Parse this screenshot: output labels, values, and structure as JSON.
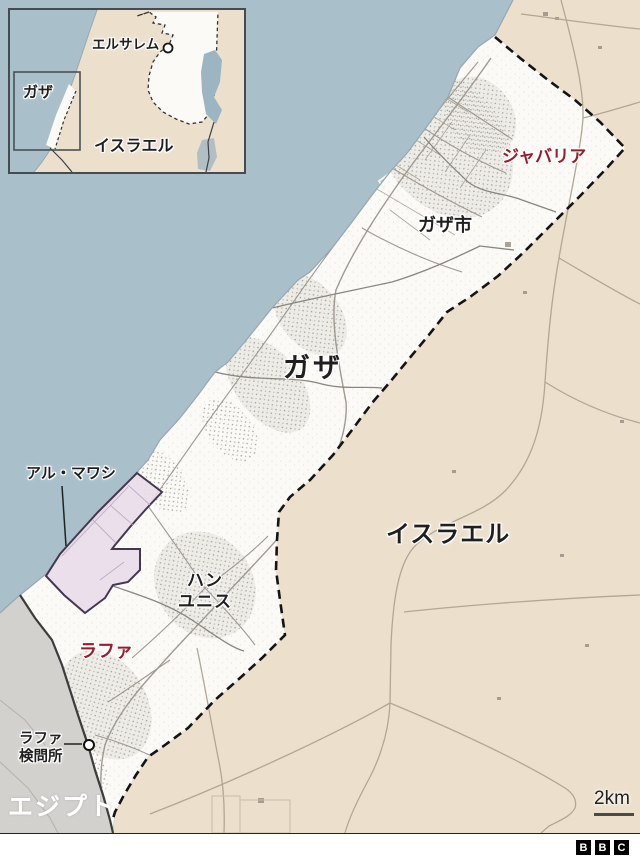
{
  "colors": {
    "sea": "#a9bfca",
    "israel": "#ece0cd",
    "gaza": "#fbfaf7",
    "egypt": "#d3d1ce",
    "dead_sea": "#9db4c2",
    "safe_zone_fill": "#e9dcea",
    "safe_zone_stroke": "#443850",
    "border_dash": "#141414",
    "border_solid": "#3c3c3c",
    "red_label": "#9c1b2b",
    "label": "#1f1f1f"
  },
  "inset": {
    "jerusalem": "エルサレム",
    "gaza": "ガザ",
    "israel": "イスラエル"
  },
  "map": {
    "jabalia": "ジャバリア",
    "gaza_city": "ガザ市",
    "gaza": "ガザ",
    "israel": "イスラエル",
    "al_mawasi": "アル・マワシ",
    "khan_younis_line1": "ハン",
    "khan_younis_line2": "ユニス",
    "rafah": "ラファ",
    "rafah_crossing_line1": "ラファ",
    "rafah_crossing_line2": "検問所",
    "egypt": "エジプト"
  },
  "scale": {
    "label": "2km"
  },
  "branding": {
    "name": "BBC",
    "letters": [
      "B",
      "B",
      "C"
    ]
  }
}
